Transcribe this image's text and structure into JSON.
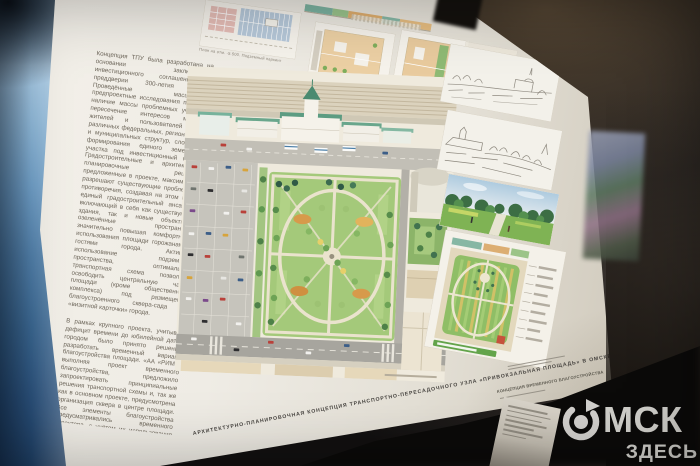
{
  "scene": {
    "watermark": {
      "wordmark_rest": "МСК",
      "wordmark_sub": "ЗДЕСЬ"
    }
  },
  "board": {
    "intro": {
      "p1": "Концепция ТПУ была разработана на основании заключённого инвестиционного соглашения в преддверии 300-летия Омска. Проведённые масштабные предпроектные исследования показали наличие массы проблемных участков, пересечение интересов местных жителей и пользователей ТПУ, различных федеральных, региональных и муниципальных структур, сложности формирования единого земельного участка под инвестиционный проект. Градостроительные и архитектурно-планировочные решения, предложенные в проекте, максимально разрешают существующие проблемы и противоречия, создавая на этом месте единый градостроительный ансамбль, включающий в себя как существующие здания, так и новые объекты и озеленённые пространства, значительно повышая комфортность использования площади горожанами и гостями города. Активное использование подземного пространства, оптимальная транспортная схема позволили освободить центральную часть площади (кроме общественного комплекса) под размещение благоустроенного сквера-сада — «визитной карточки» города.",
      "p2": "В рамках крупного проекта, учитывая дефицит времени до юбилейной даты, городом было принято решение разработать временный вариант благоустройства площади. «АА «РИМ», выполняя проект временного благоустройства, предложило запроектировать принципиальные решения транспортной схемы и, так же как в основном проекте, предусмотрена организация сквера в центре площади. Все элементы благоустройства предусматривались временного характера, с учётом их использования при реализации основного проекта."
    },
    "plans_row": [
      {
        "caption": "План на отм. -5.500. Подземный паркинг"
      },
      {
        "caption": "План на отм. 0.000. Привокзальная площадь"
      },
      {
        "caption": "План на отм. +5.500"
      }
    ],
    "title": "АРХИТЕКТУРНО-ПЛАНИРОВОЧНАЯ КОНЦЕПЦИЯ ТРАНСПОРТНО-ПЕРЕСАДОЧНОГО УЗЛА «ПРИВОКЗАЛЬНАЯ ПЛОЩАДЬ» В ОМСКЕ",
    "subtitle": "КОНЦЕПЦИЯ ВРЕМЕННОГО БЛАГОУСТРОЙСТВА"
  },
  "colors": {
    "board_paper": "#efece4",
    "park_green": "#a4c97a",
    "station_roof_green": "#5c9c82",
    "side_panel_blue": "#5d8cb4",
    "background_dark": "#161311",
    "watermark_grey": "#e6e4e0"
  }
}
